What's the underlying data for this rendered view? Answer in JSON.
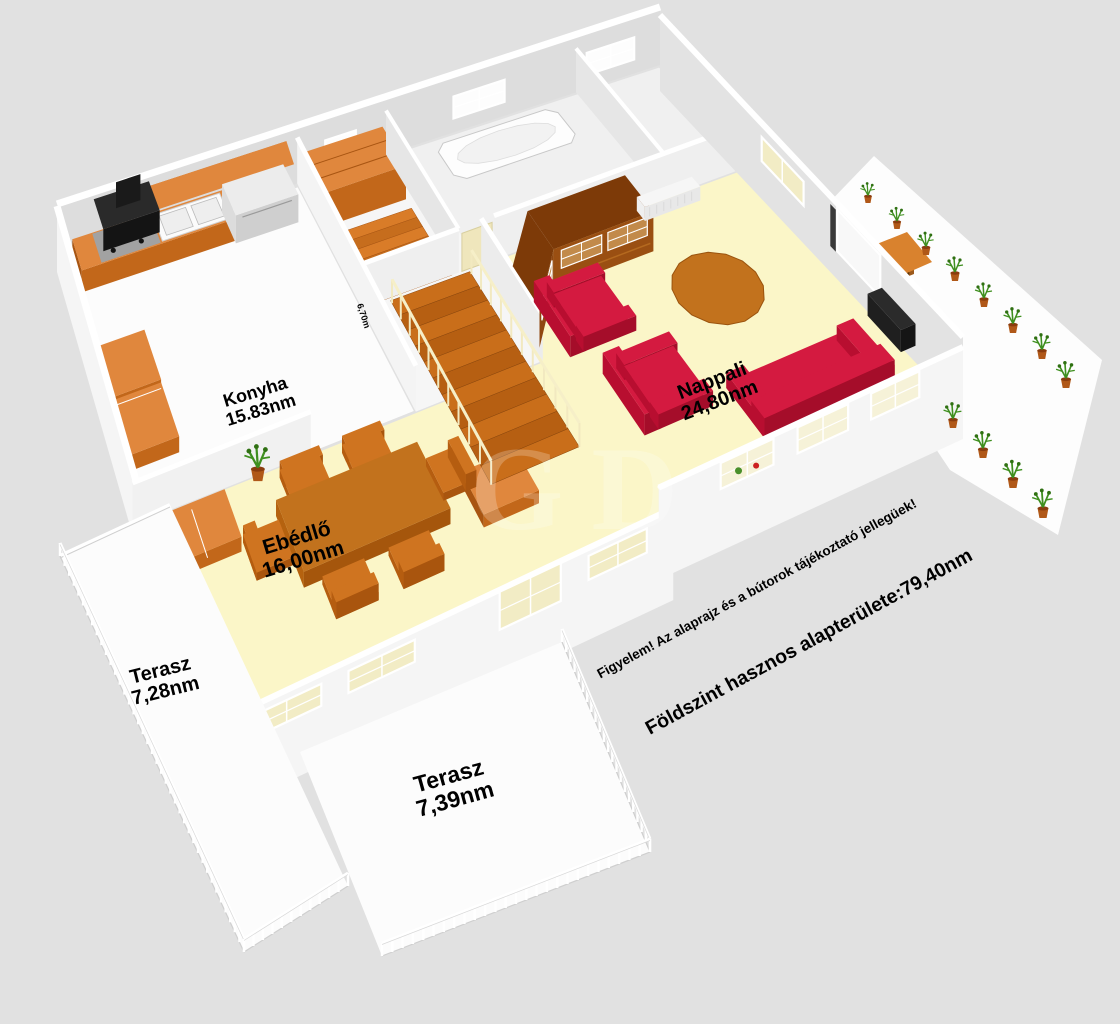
{
  "rooms": [
    {
      "id": "konyha",
      "name": "Konyha",
      "area": "15.83nm"
    },
    {
      "id": "nappali",
      "name": "Nappali",
      "area": "24,80nm"
    },
    {
      "id": "ebedlo",
      "name": "Ebédlő",
      "area": "16,00nm"
    },
    {
      "id": "terasz-bal",
      "name": "Terasz",
      "area": "7,28nm"
    },
    {
      "id": "terasz-also",
      "name": "Terasz",
      "area": "7,39nm"
    }
  ],
  "notes": {
    "disclaimer": "Figyelem! Az alaprajz és a bútorok tájékoztató jellegüek!",
    "total_area": "Földszint hasznos alapterülete:79,40nm",
    "wall_dimension": "6,70m",
    "watermark": "GD"
  },
  "colors": {
    "background": "#e1e1e1",
    "wall_top": "#ffffff",
    "wall_light": "#f5f5f5",
    "wall_mid": "#dddddd",
    "floor_cream": "#fbf6c8",
    "floor_white": "#fcfcfc",
    "floor_back": "#f0f0f0",
    "furniture_orange": "#e0873d",
    "furniture_orange_side": "#c2671a",
    "furniture_orange_west": "#a85512",
    "stairs_orange": "#c96e1a",
    "stairs_orange_dark": "#b65f12",
    "cabinet_brown": "#9a4f12",
    "cabinet_brown_dark": "#7d3a08",
    "cabinet_glass": "#c28a4a",
    "seat_red": "#d41a40",
    "seat_red_dark": "#a50d2a",
    "seat_red_mid": "#b80e30",
    "table_brown": "#c2721d",
    "pane_cream": "#f2ecc5",
    "plant_green": "#3f8f1f",
    "pot_terracotta": "#b05818",
    "text": "#000000"
  }
}
